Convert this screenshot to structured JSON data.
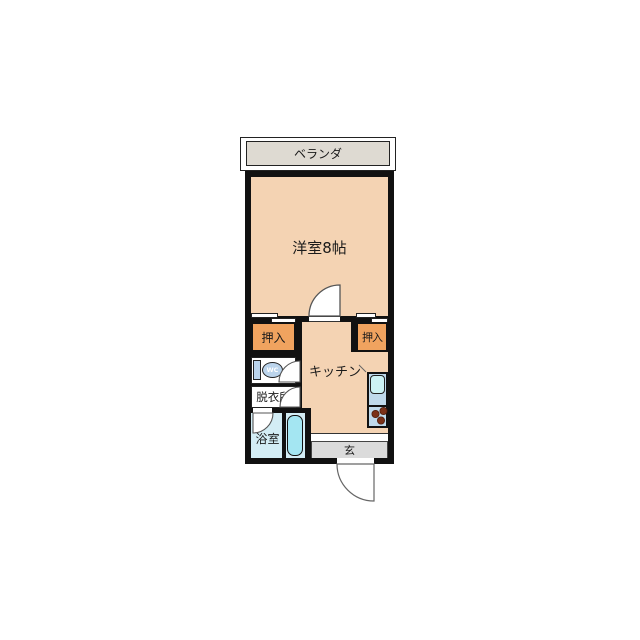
{
  "floorplan": {
    "balcony_label": "ベランダ",
    "main_room_label": "洋室8帖",
    "closet_left_label": "押入",
    "closet_right_label": "押入",
    "kitchen_label": "キッチン",
    "wc_label": "WC",
    "dressing_room_label": "脱衣所",
    "bathroom_label": "浴室",
    "entrance_label": "玄",
    "colors": {
      "room_floor": "#F4D3B3",
      "closet": "#F0A35F",
      "balcony": "#DEDAD2",
      "entrance": "#DBDBDB",
      "bathroom": "#D3EDF5",
      "bathtub": "#A4E6F2",
      "counter": "#BFD9EB",
      "sink": "#CCF2F4",
      "burner": "#7B3118",
      "wall": "#111111"
    }
  }
}
